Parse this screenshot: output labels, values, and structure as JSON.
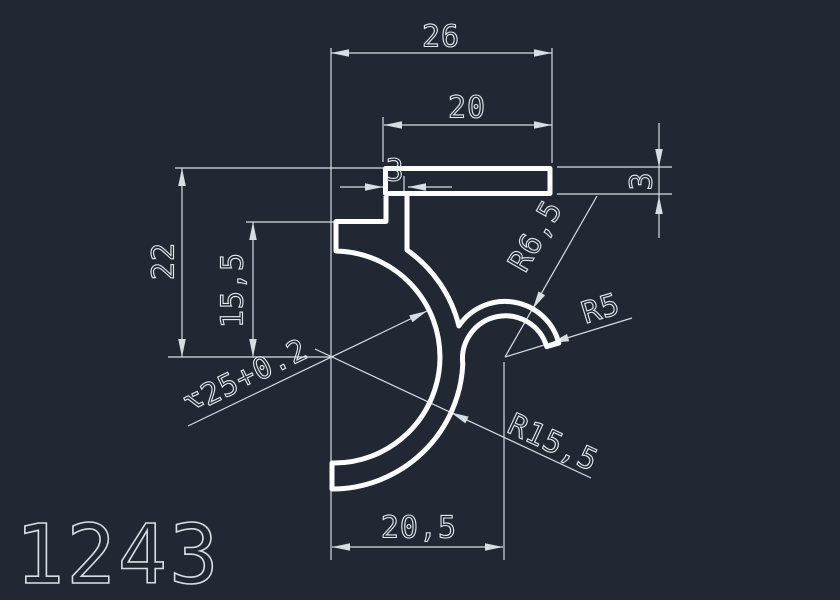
{
  "drawing": {
    "part_number": "1243",
    "colors": {
      "background": "#212834",
      "profile_line": "#fdfdfe",
      "dimension_line": "#d7dde3",
      "dimension_text": "#e4e9ee",
      "part_number_text": "#d9dee4"
    },
    "dimensions": {
      "total_width": "26",
      "flange_length": "20",
      "step_offset": "3",
      "flange_thickness": "3",
      "total_height": "22",
      "bore_center_height": "15,5",
      "bottom_width": "20,5",
      "bore_diameter": "⌥25+0.2",
      "outer_radius": "R15,5",
      "hook_outer_radius": "R6,5",
      "hook_inner_radius": "R5"
    }
  }
}
